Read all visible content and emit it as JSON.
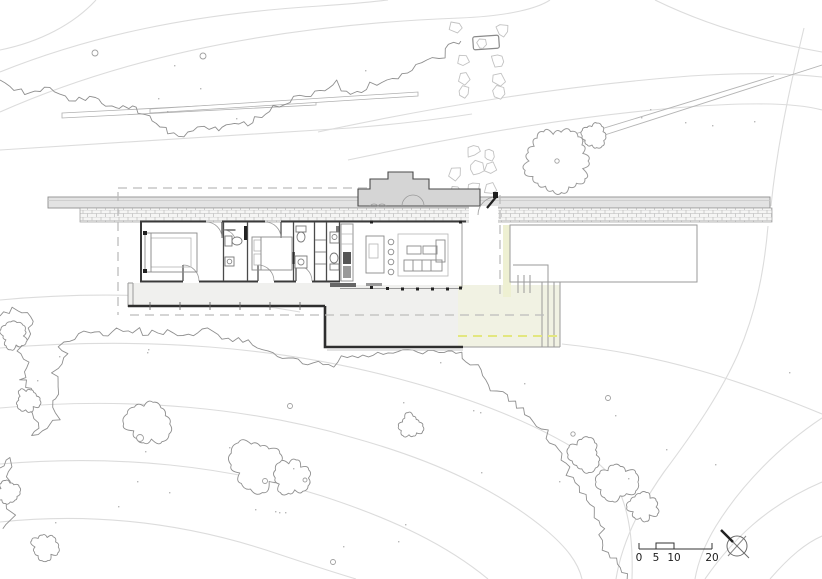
{
  "document": {
    "kind": "architectural site and floor plan",
    "paper_color": "#ffffff"
  },
  "colors": {
    "contour": "#dcdcdc",
    "vegetation": "#8f8f8f",
    "stone_outline": "#c2c2c2",
    "wall": "#3a3a3a",
    "roof_fill": "#e3e3e3",
    "roof_edge": "#8f8f8f",
    "masonry_joint": "#b3b3b3",
    "chimney_fill": "#d5d5d5",
    "deck_fill": "#f0f0ee",
    "terrace_tint": "#f1f2e3",
    "planter_tint": "#eef0d2",
    "dash_gray": "#bcbcbc",
    "dash_yellow": "#e3e77f",
    "furniture": "#8a8a8a",
    "column": "#222222",
    "heavy_edge": "#2e2e2e",
    "text": "#1c1c1c"
  },
  "scale_bar": {
    "ticks": [
      "0",
      "5",
      "10",
      "20"
    ]
  },
  "compass": {
    "icon": "north-arrow-icon"
  },
  "features": [
    "contour-lines",
    "vegetation-scrub-line",
    "tree-canopy",
    "shrubs",
    "boulders",
    "stepping-stone-path",
    "timber-retaining-walls",
    "hillside-path",
    "long-roof-canopy",
    "stone-spine-wall",
    "fireplace-chimney-mass",
    "entry-door",
    "bedroom",
    "bathroom",
    "wardrobe",
    "kitchen-counter",
    "kitchen-island",
    "island-stools",
    "sofa-seating",
    "coffee-tables",
    "south-walkway-deck",
    "sunken-terrace",
    "terrace-steps",
    "east-deck",
    "roof-overhang-dashed",
    "terrace-edge-dashed-yellow",
    "scale-bar",
    "north-arrow"
  ]
}
